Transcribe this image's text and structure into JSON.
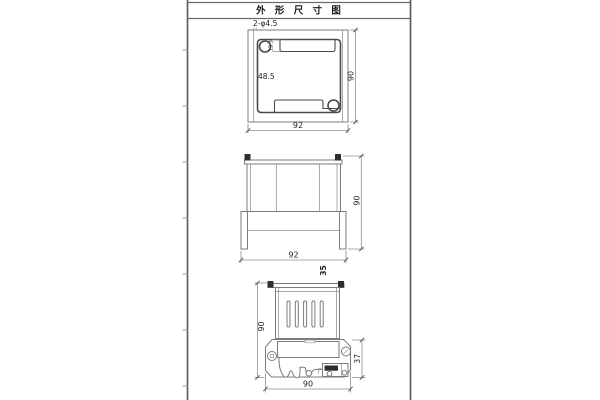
{
  "title": "外 形 尺 寸 图",
  "top_view": {
    "holes_label": "2-φ4.5",
    "notch_dim": "13.3",
    "slot_dim": "48.5",
    "height_dim": "90",
    "width_dim": "92"
  },
  "front_view": {
    "height_dim": "90",
    "width_dim": "92",
    "depth_dim": "35"
  },
  "side_view": {
    "height_dim": "90",
    "bracket_dim": "37",
    "width_dim": "90"
  },
  "colors": {
    "background": "#ffffff",
    "frame_line": "#5f5f5f",
    "drawing_line": "#7b7b7b",
    "cavity_line": "#4a4a4a",
    "dimension_line": "#8f8f8f",
    "dark_fill": "#2e2e2e",
    "text": "#222222"
  }
}
